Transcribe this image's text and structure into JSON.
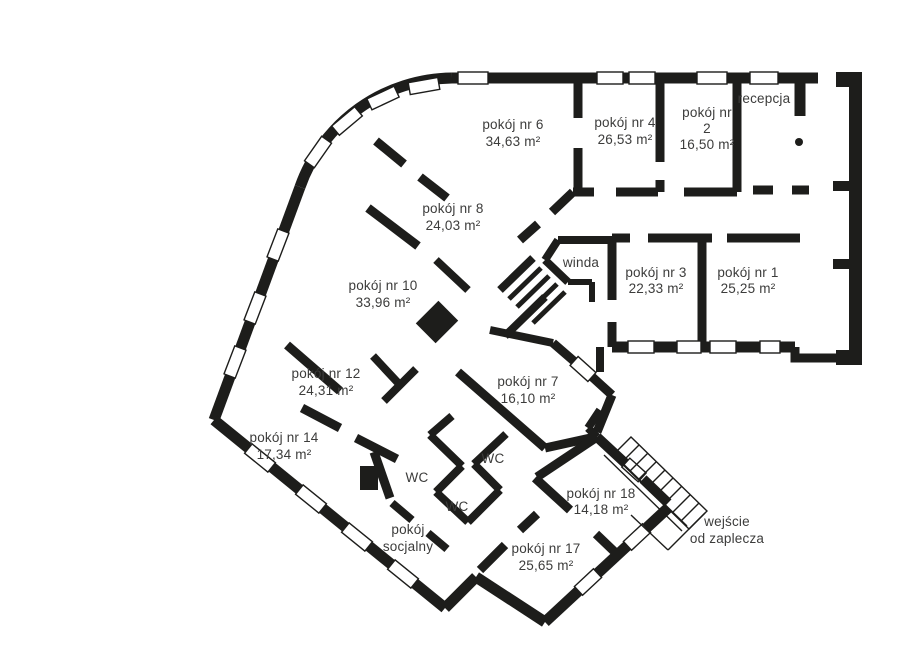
{
  "plan": {
    "title": "floor-plan-office-level",
    "colors": {
      "wall": "#1d1d1b",
      "text": "#3c3c3b",
      "background": "#ffffff"
    },
    "rooms": [
      {
        "label": "pokój nr 6",
        "area": "34,63 m²"
      },
      {
        "label": "pokój nr 4",
        "area": "26,53 m²"
      },
      {
        "label": "pokój nr",
        "number": "2",
        "area": "16,50 m²"
      },
      {
        "label": "recepcja"
      },
      {
        "label": "pokój nr 8",
        "area": "24,03 m²"
      },
      {
        "label": "pokój nr 10",
        "area": "33,96 m²"
      },
      {
        "label": "winda"
      },
      {
        "label": "pokój nr 3",
        "area": "22,33 m²"
      },
      {
        "label": "pokój nr 1",
        "area": "25,25 m²"
      },
      {
        "label": "pokój nr 12",
        "area": "24,31 m²"
      },
      {
        "label": "pokój nr 7",
        "area": "16,10 m²"
      },
      {
        "label": "pokój nr 14",
        "area": "17,34 m²"
      },
      {
        "label": "WC"
      },
      {
        "label": "WC"
      },
      {
        "label": "WC"
      },
      {
        "label": "pokój nr 18",
        "area": "14,18 m²"
      },
      {
        "label": "pokój",
        "label2": "socjalny"
      },
      {
        "label": "pokój nr 17",
        "area": "25,65 m²"
      },
      {
        "label": "wejście",
        "label2": "od zaplecza"
      }
    ]
  }
}
